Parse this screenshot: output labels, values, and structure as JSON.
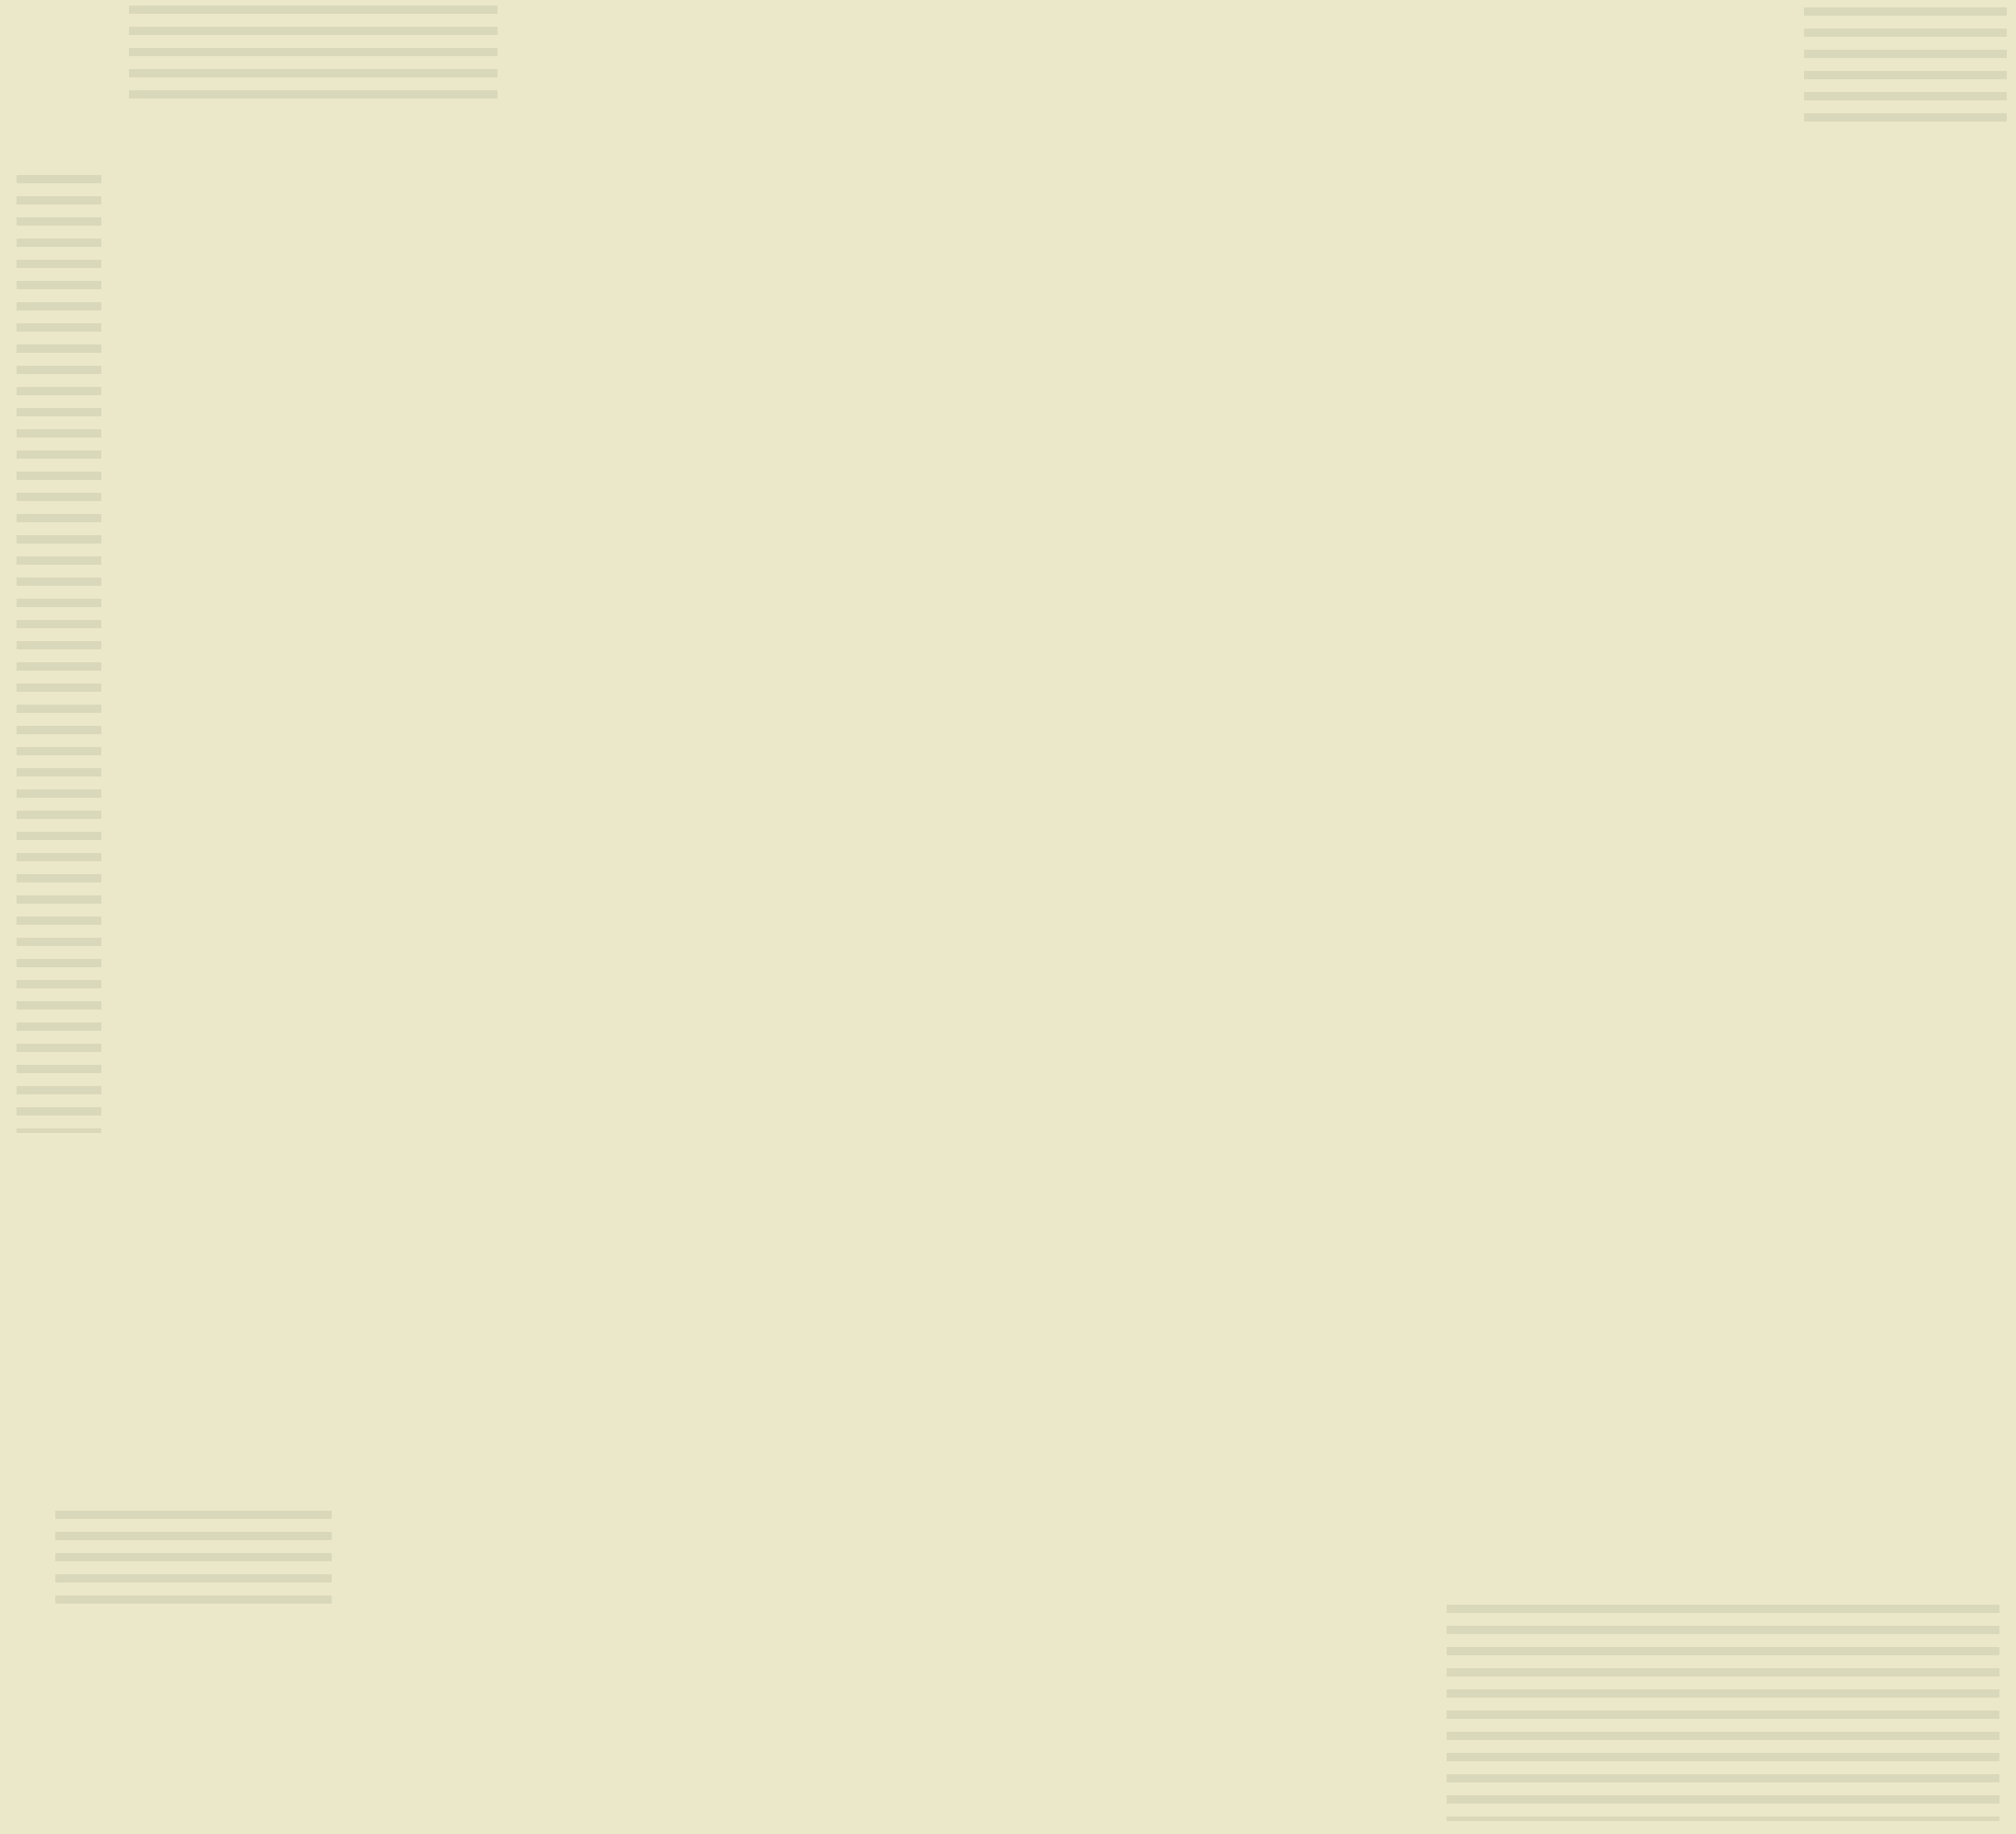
{
  "caption": "(圖：王明雄提供)",
  "signature": "玲.",
  "center": {
    "label": "中方土"
  },
  "directions": [
    {
      "id": "north",
      "label": "北方水(冬)"
    },
    {
      "id": "east",
      "label": "東方木(春)"
    },
    {
      "id": "south",
      "label": "南方火(夏)"
    },
    {
      "id": "west",
      "label": "西方金(秋)"
    }
  ],
  "sectors": [
    {
      "branch": "子",
      "zodiac": "rat",
      "zodiac_char": "鼠",
      "hours": "23-1",
      "term": "大雪—小寒",
      "dates": "12/7/8-1/5/6"
    },
    {
      "branch": "丑",
      "zodiac": "ox",
      "zodiac_char": "牛",
      "hours": "1-3",
      "term": "小寒—立春",
      "dates": "1/5/6-2/4/5"
    },
    {
      "branch": "寅",
      "zodiac": "tiger",
      "zodiac_char": "虎",
      "hours": "3-5",
      "term": "立春—驚蟄",
      "dates": "2/4/5-3/5/6"
    },
    {
      "branch": "卯",
      "zodiac": "rabbit",
      "zodiac_char": "兔",
      "hours": "5-7",
      "term": "驚蟄—清明",
      "dates": "3/5/6-4/5"
    },
    {
      "branch": "辰",
      "zodiac": "dragon",
      "zodiac_char": "龍",
      "hours": "7-9",
      "term": "清明—立夏",
      "dates": "4/5-5/6"
    },
    {
      "branch": "巳",
      "zodiac": "snake",
      "zodiac_char": "蛇",
      "hours": "9-11",
      "term": "立夏—芒種",
      "dates": "5/6-6/6"
    },
    {
      "branch": "午",
      "zodiac": "horse",
      "zodiac_char": "馬",
      "hours": "11-13",
      "term": "芒種—小暑",
      "dates": "6/6-7/7"
    },
    {
      "branch": "未",
      "zodiac": "goat",
      "zodiac_char": "羊",
      "hours": "13-15",
      "term": "小暑—立秋",
      "dates": "7/7-8/8"
    },
    {
      "branch": "申",
      "zodiac": "monkey",
      "zodiac_char": "猴",
      "hours": "15-17",
      "term": "立秋—白露",
      "dates": "8/8-9/8"
    },
    {
      "branch": "酉",
      "zodiac": "rooster",
      "zodiac_char": "雞",
      "hours": "17-19",
      "term": "白露—寒露",
      "dates": "9/8-10/8/9"
    },
    {
      "branch": "戌",
      "zodiac": "dog",
      "zodiac_char": "狗",
      "hours": "19-21",
      "term": "寒露—立冬",
      "dates": "10/8/9-11/8/7"
    },
    {
      "branch": "亥",
      "zodiac": "pig",
      "zodiac_char": "豬",
      "hours": "21-23",
      "term": "立冬—大雪",
      "dates": "11/8/7-12/7/8"
    }
  ],
  "colors": {
    "page_bg": "#ebe8c9",
    "ring_cream": "#f2efc8",
    "ring_pink": "#e8c3dc",
    "center_fill": "#eef0e8",
    "triangle_fill": "#f0eec3",
    "ink": "#1d1b18",
    "orange_rule": "#dc7a2e",
    "water_blue": "#ccdae3",
    "leaf_green": "#b2d28b",
    "grass_green": "#a5c979",
    "cloud_pink": "#e9c9df",
    "moon_pink": "#e4bcd8",
    "trunk_white": "#f5f3e8"
  }
}
